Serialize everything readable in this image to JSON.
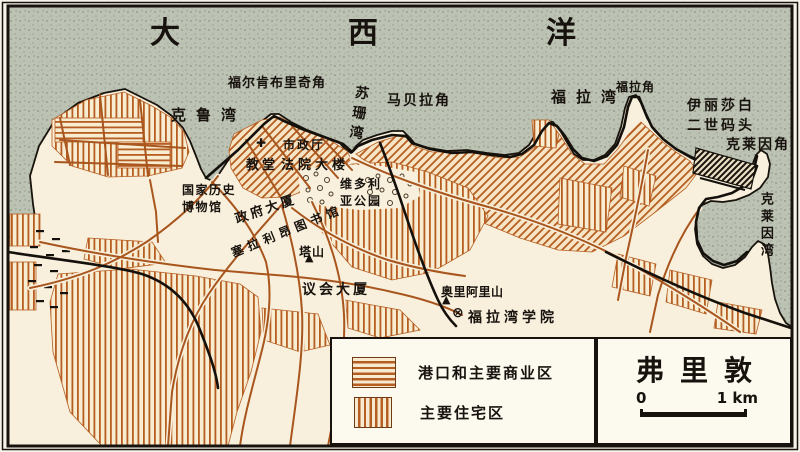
{
  "figure": {
    "title": "弗里敦",
    "scale_bar": {
      "start_label": "0",
      "end_label": "1 km"
    },
    "legend": {
      "items": [
        {
          "id": "commercial",
          "label": "港口和主要商业区",
          "swatch": "horizontal-hatch"
        },
        {
          "id": "residential",
          "label": "主要住宅区",
          "swatch": "vertical-hatch"
        }
      ]
    }
  },
  "labels": [
    {
      "id": "atlantic-ocean",
      "text": "大西洋",
      "x": 150,
      "y": 12,
      "size": 30,
      "ls": 168
    },
    {
      "id": "cape-falconbridge",
      "text": "福尔肯布里奇角",
      "x": 228,
      "y": 75,
      "size": 13,
      "ls": 1
    },
    {
      "id": "kroo-bay",
      "text": "克鲁湾",
      "x": 171,
      "y": 105,
      "size": 15,
      "ls": 10
    },
    {
      "id": "susan-bay",
      "text": "苏珊湾",
      "x": 352,
      "y": 84,
      "size": 14,
      "ls": 6,
      "vertical": true,
      "rotate": 8
    },
    {
      "id": "cape-marbella",
      "text": "马贝拉角",
      "x": 387,
      "y": 91,
      "size": 14,
      "ls": 2
    },
    {
      "id": "cape-fourah",
      "text": "福拉角",
      "x": 616,
      "y": 79,
      "size": 12,
      "ls": 1
    },
    {
      "id": "fourah-bay",
      "text": "福拉湾",
      "x": 551,
      "y": 87,
      "size": 15,
      "ls": 10
    },
    {
      "id": "qe2-quay",
      "text": "伊丽莎白\n二世码头",
      "x": 687,
      "y": 96,
      "size": 14,
      "ls": 3
    },
    {
      "id": "cape-cline",
      "text": "克莱因角",
      "x": 726,
      "y": 135,
      "size": 14,
      "ls": 2
    },
    {
      "id": "cline-bay",
      "text": "克莱因湾",
      "x": 755,
      "y": 192,
      "size": 13,
      "ls": 4,
      "vertical": true
    },
    {
      "id": "city-hall",
      "text": "市政厅",
      "x": 283,
      "y": 137,
      "size": 12,
      "ls": 2
    },
    {
      "id": "church",
      "text": "教堂",
      "x": 246,
      "y": 157,
      "size": 13,
      "ls": 3
    },
    {
      "id": "law-courts",
      "text": "法院大楼",
      "x": 281,
      "y": 157,
      "size": 13,
      "ls": 4
    },
    {
      "id": "national-history-museum",
      "text": "国家历史\n博物馆",
      "x": 182,
      "y": 182,
      "size": 12,
      "ls": 1.5
    },
    {
      "id": "victoria-park",
      "text": "维多利\n亚公园",
      "x": 340,
      "y": 176,
      "size": 12,
      "ls": 2
    },
    {
      "id": "government-house",
      "text": "政府大厦",
      "x": 233,
      "y": 212,
      "size": 13,
      "ls": 3,
      "rotate": -19
    },
    {
      "id": "sierra-leone-library",
      "text": "塞拉利昂图书馆",
      "x": 229,
      "y": 246,
      "size": 12,
      "ls": 5,
      "rotate": -22
    },
    {
      "id": "tower-hill",
      "text": "塔山",
      "x": 299,
      "y": 244,
      "size": 12,
      "ls": 1
    },
    {
      "id": "parliament-building",
      "text": "议会大厦",
      "x": 302,
      "y": 280,
      "size": 14,
      "ls": 3
    },
    {
      "id": "mount-aureol",
      "text": "奥里阿里山",
      "x": 441,
      "y": 284,
      "size": 12,
      "ls": 0.5
    },
    {
      "id": "fourah-bay-college",
      "text": "福拉湾学院",
      "x": 468,
      "y": 308,
      "size": 14,
      "ls": 4
    }
  ],
  "markers": [
    {
      "id": "city-hall-cross",
      "symbol": "✚",
      "x": 256,
      "y": 137,
      "size": 12
    },
    {
      "id": "tower-hill-peak",
      "symbol": "▲",
      "x": 305,
      "y": 252,
      "size": 11
    },
    {
      "id": "mount-aureol-peak",
      "symbol": "▲",
      "x": 442,
      "y": 294,
      "size": 11
    },
    {
      "id": "fourah-bay-college-symbol",
      "symbol": "⊗",
      "x": 452,
      "y": 306,
      "size": 14
    }
  ],
  "colors": {
    "sea": "#bcc2b4",
    "land": "#f8f0dc",
    "hatch": "#b65e22",
    "road": "#a8551e",
    "ink": "#17120d",
    "box_bg": "#fcf9ef"
  }
}
